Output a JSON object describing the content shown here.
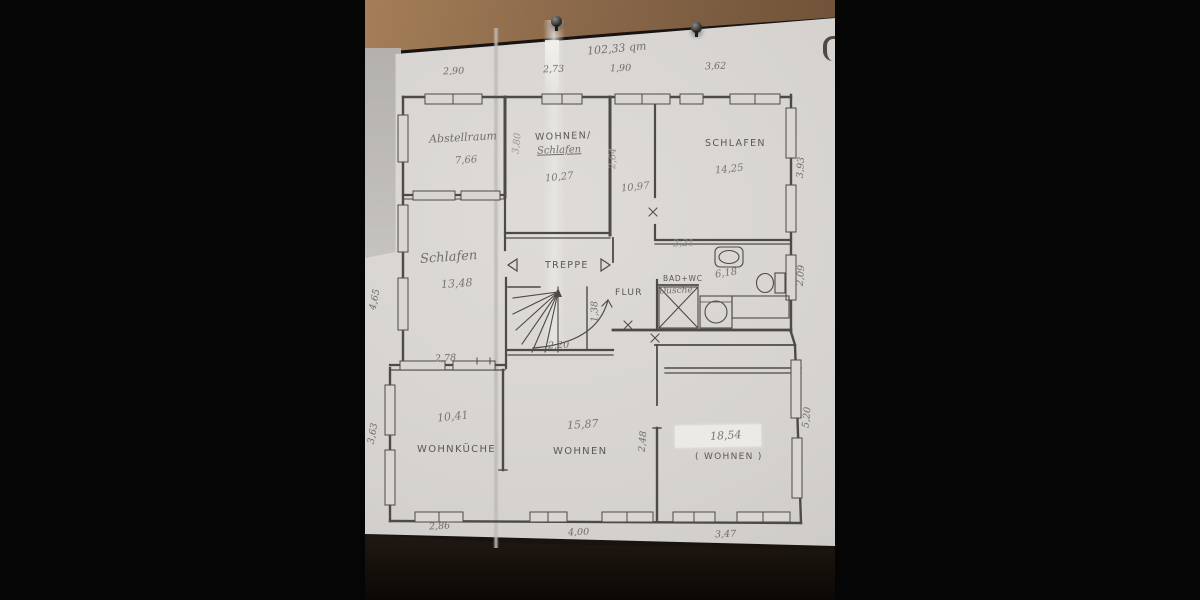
{
  "scene": {
    "description": "photo of a hand-drawn floor plan pinned to a wooden board",
    "background_color": "#050505",
    "wood_color": "#8a684a",
    "paper_color": "#d5d2cf",
    "ink_color": "#4e4a45",
    "icons": {
      "pin_left": "push-pin-icon",
      "pin_right": "push-pin-icon",
      "hook": "wall-hook-icon",
      "stairs": "stairs-icon",
      "sink": "sink-icon",
      "toilet": "toilet-icon",
      "shower": "shower-icon",
      "washer": "washing-machine-icon",
      "arrow_left": "arrow-left-icon",
      "arrow_right": "arrow-right-icon"
    }
  },
  "plan": {
    "total_area": "102,33 qm",
    "rooms": {
      "abstellraum": {
        "label": "Abstellraum",
        "area": "7,66"
      },
      "wohnen_schlafen": {
        "label": "WOHNEN/",
        "label2": "Schlafen",
        "area": "10,27"
      },
      "schlafen_gross": {
        "label": "SCHLAFEN",
        "area": "14,25"
      },
      "schlafen_mitte": {
        "label": "Schlafen",
        "area": "13,48"
      },
      "treppe": {
        "label": "TREPPE",
        "width": "2,20",
        "depth": "1,38"
      },
      "flur": {
        "label": "FLUR",
        "length": "10,97"
      },
      "bad_wc": {
        "label": "BAD+WC",
        "sub_label": "Dusche",
        "area": "6,18",
        "top_dim": "2,21"
      },
      "wohnkueche": {
        "label": "WOHNKÜCHE",
        "area": "10,41"
      },
      "wohnen": {
        "label": "WOHNEN",
        "area": "15,87"
      },
      "wohnen_klammer": {
        "label": "( WOHNEN )",
        "area": "18,54"
      }
    },
    "dims": {
      "top": [
        "2,90",
        "2,73",
        "1,90",
        "3,62"
      ],
      "bottom": [
        "2,86",
        "4,00",
        "3,47"
      ],
      "left": [
        "4,65",
        "3,63"
      ],
      "right": [
        "3,93",
        "2,09",
        "5,20"
      ],
      "inner": {
        "schlafen_unten": "2,78",
        "wand_links": "3,80",
        "flur_wand": "2,64",
        "wohnen_rechts": "2,48"
      }
    }
  }
}
